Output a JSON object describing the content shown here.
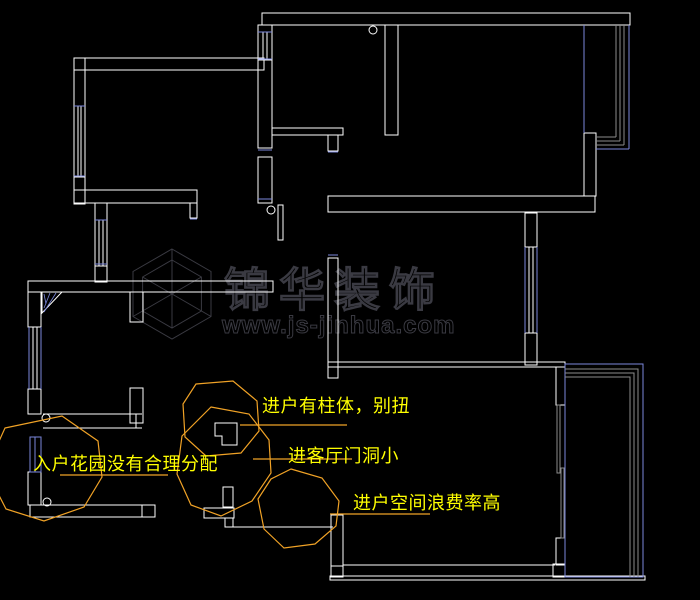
{
  "canvas": {
    "background": "#000000",
    "width": 700,
    "height": 600
  },
  "annotations": {
    "color": "#ffff00",
    "cloud_color": "#f0a226",
    "items": [
      {
        "label": "进户有柱体，别扭"
      },
      {
        "label": "进客厅门洞小"
      },
      {
        "label": "进户空间浪费率高"
      },
      {
        "label": "入户花园没有合理分配"
      }
    ]
  },
  "watermark": {
    "brand": "锦华装饰",
    "url": "www.js-jinhua.com",
    "color": "#3a3a42"
  },
  "colors": {
    "wall": "#ffffff",
    "window": "#7b87dd",
    "mullion": "#8c8c8c",
    "door": "#909090",
    "background": "#000000"
  },
  "icons": {
    "door_hinge": "door-hinge-circle",
    "logo": "jinhua-cube-logo"
  }
}
